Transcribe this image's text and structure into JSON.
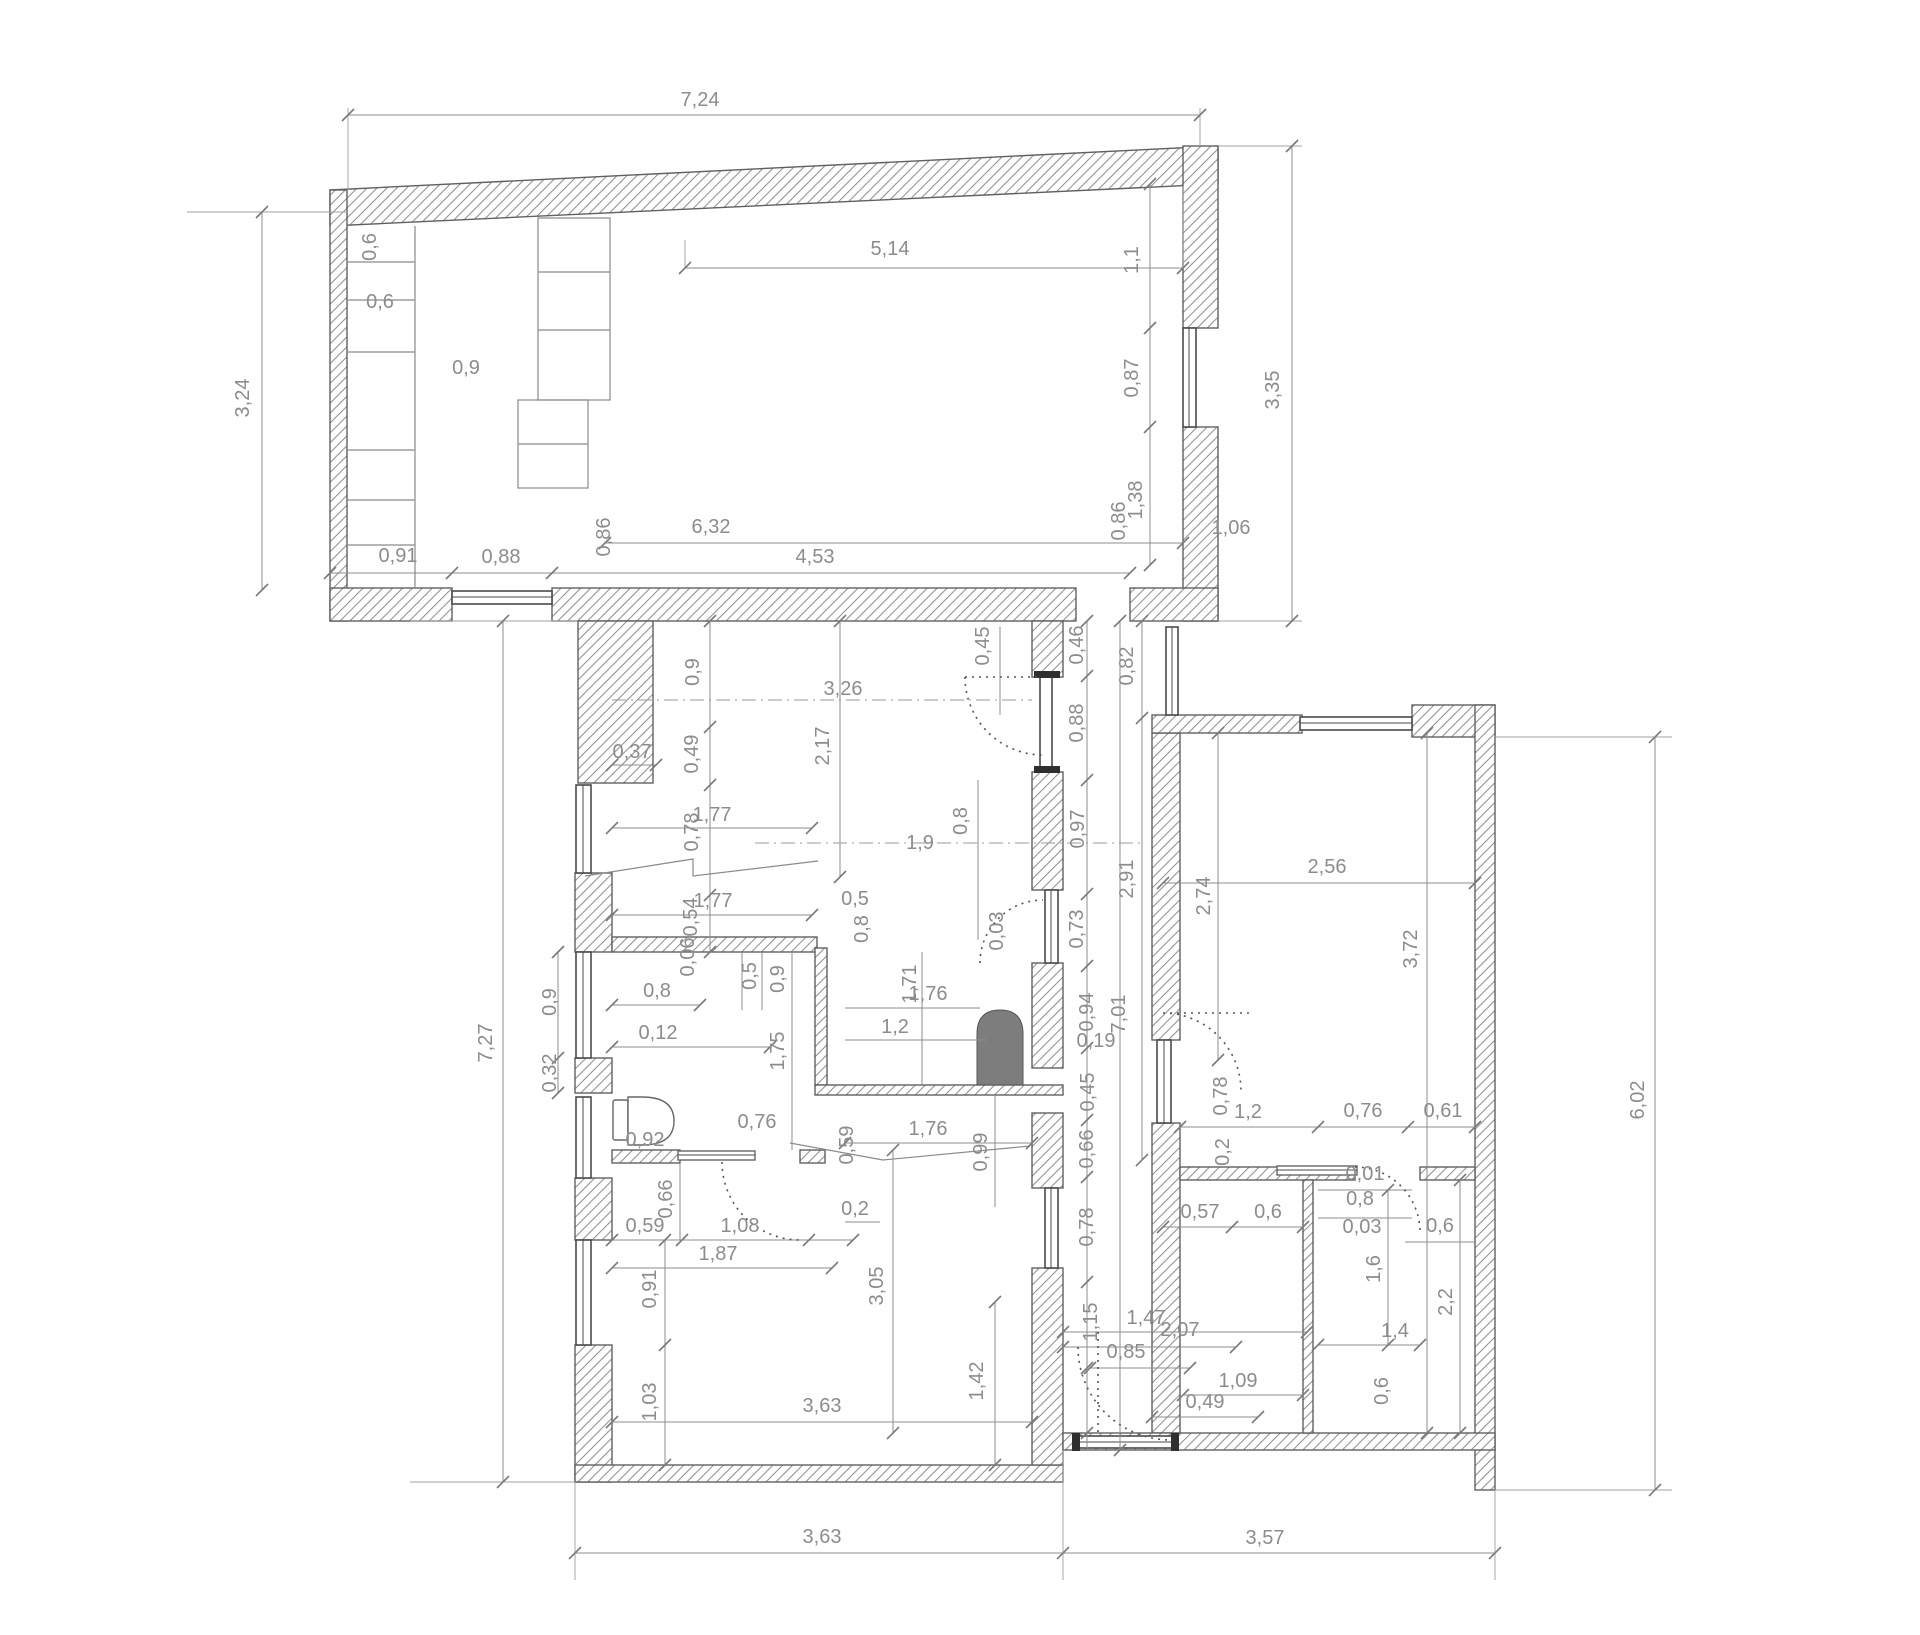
{
  "drawing": {
    "type_label": "floor-plan",
    "colors": {
      "background": "#ffffff",
      "dimension_text": "#8c8c8c",
      "wall_outline": "#606060",
      "hatch": "#909090",
      "stove_fill": "#7d7d7d",
      "door_cap": "#2f2f2f"
    },
    "labels": [
      {
        "t": "7,24",
        "x": 700,
        "y": 100,
        "r": 0
      },
      {
        "t": "3,24",
        "x": 243,
        "y": 398,
        "r": 1
      },
      {
        "t": "0,6",
        "x": 370,
        "y": 247,
        "r": 1
      },
      {
        "t": "0,6",
        "x": 380,
        "y": 302,
        "r": 0
      },
      {
        "t": "0,9",
        "x": 466,
        "y": 368,
        "r": 0
      },
      {
        "t": "5,14",
        "x": 890,
        "y": 249,
        "r": 0
      },
      {
        "t": "1,1",
        "x": 1132,
        "y": 260,
        "r": 1
      },
      {
        "t": "0,87",
        "x": 1132,
        "y": 378,
        "r": 1
      },
      {
        "t": "1,38",
        "x": 1136,
        "y": 500,
        "r": 1
      },
      {
        "t": "0,86",
        "x": 1119,
        "y": 521,
        "r": 1
      },
      {
        "t": "1,06",
        "x": 1231,
        "y": 528,
        "r": 0
      },
      {
        "t": "3,35",
        "x": 1273,
        "y": 390,
        "r": 1
      },
      {
        "t": "0,91",
        "x": 398,
        "y": 556,
        "r": 0
      },
      {
        "t": "0,88",
        "x": 501,
        "y": 557,
        "r": 0
      },
      {
        "t": "0,86",
        "x": 604,
        "y": 537,
        "r": 1
      },
      {
        "t": "6,32",
        "x": 711,
        "y": 527,
        "r": 0
      },
      {
        "t": "4,53",
        "x": 815,
        "y": 557,
        "r": 0
      },
      {
        "t": "0,9",
        "x": 693,
        "y": 672,
        "r": 1
      },
      {
        "t": "3,26",
        "x": 843,
        "y": 689,
        "r": 0
      },
      {
        "t": "0,37",
        "x": 632,
        "y": 752,
        "r": 0
      },
      {
        "t": "0,49",
        "x": 692,
        "y": 754,
        "r": 1
      },
      {
        "t": "2,17",
        "x": 823,
        "y": 746,
        "r": 1
      },
      {
        "t": "1,77",
        "x": 712,
        "y": 815,
        "r": 0
      },
      {
        "t": "0,78",
        "x": 692,
        "y": 832,
        "r": 1
      },
      {
        "t": "1,9",
        "x": 920,
        "y": 843,
        "r": 0
      },
      {
        "t": "1,77",
        "x": 713,
        "y": 901,
        "r": 0
      },
      {
        "t": "0,54",
        "x": 691,
        "y": 917,
        "r": 1
      },
      {
        "t": "0,45",
        "x": 983,
        "y": 646,
        "r": 1
      },
      {
        "t": "0,46",
        "x": 1077,
        "y": 645,
        "r": 1
      },
      {
        "t": "0,82",
        "x": 1127,
        "y": 666,
        "r": 1
      },
      {
        "t": "0,88",
        "x": 1077,
        "y": 723,
        "r": 1
      },
      {
        "t": "0,97",
        "x": 1078,
        "y": 829,
        "r": 1
      },
      {
        "t": "2,91",
        "x": 1127,
        "y": 879,
        "r": 1
      },
      {
        "t": "0,8",
        "x": 961,
        "y": 821,
        "r": 1
      },
      {
        "t": "0,73",
        "x": 1077,
        "y": 929,
        "r": 1
      },
      {
        "t": "0,03",
        "x": 997,
        "y": 931,
        "r": 1
      },
      {
        "t": "0,94",
        "x": 1087,
        "y": 1012,
        "r": 1
      },
      {
        "t": "0,19",
        "x": 1096,
        "y": 1041,
        "r": 0
      },
      {
        "t": "7,01",
        "x": 1119,
        "y": 1014,
        "r": 1
      },
      {
        "t": "0,45",
        "x": 1088,
        "y": 1092,
        "r": 1
      },
      {
        "t": "0,66",
        "x": 1087,
        "y": 1149,
        "r": 1
      },
      {
        "t": "0,78",
        "x": 1087,
        "y": 1227,
        "r": 1
      },
      {
        "t": "1,15",
        "x": 1091,
        "y": 1322,
        "r": 1
      },
      {
        "t": "1,47",
        "x": 1146,
        "y": 1318,
        "r": 0
      },
      {
        "t": "0,85",
        "x": 1126,
        "y": 1352,
        "r": 0
      },
      {
        "t": "2,07",
        "x": 1180,
        "y": 1330,
        "r": 0
      },
      {
        "t": "0,5",
        "x": 750,
        "y": 976,
        "r": 1
      },
      {
        "t": "0,9",
        "x": 778,
        "y": 979,
        "r": 1
      },
      {
        "t": "0,8",
        "x": 657,
        "y": 991,
        "r": 0
      },
      {
        "t": "0,12",
        "x": 658,
        "y": 1033,
        "r": 0
      },
      {
        "t": "1,75",
        "x": 778,
        "y": 1051,
        "r": 1
      },
      {
        "t": "0,06",
        "x": 688,
        "y": 957,
        "r": 1
      },
      {
        "t": "0,8",
        "x": 862,
        "y": 929,
        "r": 1
      },
      {
        "t": "0,5",
        "x": 855,
        "y": 899,
        "r": 0
      },
      {
        "t": "1,71",
        "x": 910,
        "y": 984,
        "r": 1
      },
      {
        "t": "1,76",
        "x": 928,
        "y": 994,
        "r": 0
      },
      {
        "t": "1,2",
        "x": 895,
        "y": 1027,
        "r": 0
      },
      {
        "t": "1,76",
        "x": 928,
        "y": 1129,
        "r": 0
      },
      {
        "t": "0,59",
        "x": 847,
        "y": 1145,
        "r": 1
      },
      {
        "t": "0,99",
        "x": 981,
        "y": 1152,
        "r": 1
      },
      {
        "t": "0,2",
        "x": 855,
        "y": 1209,
        "r": 0
      },
      {
        "t": "0,76",
        "x": 757,
        "y": 1122,
        "r": 0
      },
      {
        "t": "0,92",
        "x": 645,
        "y": 1140,
        "r": 0
      },
      {
        "t": "7,27",
        "x": 486,
        "y": 1043,
        "r": 1
      },
      {
        "t": "0,9",
        "x": 550,
        "y": 1002,
        "r": 1
      },
      {
        "t": "0,32",
        "x": 550,
        "y": 1073,
        "r": 1
      },
      {
        "t": "0,66",
        "x": 666,
        "y": 1199,
        "r": 1
      },
      {
        "t": "0,59",
        "x": 645,
        "y": 1226,
        "r": 0
      },
      {
        "t": "1,08",
        "x": 740,
        "y": 1226,
        "r": 0
      },
      {
        "t": "1,87",
        "x": 718,
        "y": 1254,
        "r": 0
      },
      {
        "t": "0,91",
        "x": 650,
        "y": 1289,
        "r": 1
      },
      {
        "t": "3,05",
        "x": 877,
        "y": 1286,
        "r": 1
      },
      {
        "t": "1,03",
        "x": 650,
        "y": 1402,
        "r": 1
      },
      {
        "t": "3,63",
        "x": 822,
        "y": 1406,
        "r": 0
      },
      {
        "t": "1,42",
        "x": 977,
        "y": 1381,
        "r": 1
      },
      {
        "t": "3,63",
        "x": 822,
        "y": 1537,
        "r": 0
      },
      {
        "t": "3,57",
        "x": 1265,
        "y": 1538,
        "r": 0
      },
      {
        "t": "2,56",
        "x": 1327,
        "y": 867,
        "r": 0
      },
      {
        "t": "2,74",
        "x": 1204,
        "y": 896,
        "r": 1
      },
      {
        "t": "3,72",
        "x": 1411,
        "y": 949,
        "r": 1
      },
      {
        "t": "6,02",
        "x": 1638,
        "y": 1100,
        "r": 1
      },
      {
        "t": "0,78",
        "x": 1221,
        "y": 1096,
        "r": 1
      },
      {
        "t": "1,2",
        "x": 1248,
        "y": 1112,
        "r": 0
      },
      {
        "t": "0,76",
        "x": 1363,
        "y": 1111,
        "r": 0
      },
      {
        "t": "0,61",
        "x": 1443,
        "y": 1111,
        "r": 0
      },
      {
        "t": "0,2",
        "x": 1223,
        "y": 1152,
        "r": 1
      },
      {
        "t": "0,01",
        "x": 1365,
        "y": 1174,
        "r": 0
      },
      {
        "t": "0,8",
        "x": 1360,
        "y": 1199,
        "r": 0
      },
      {
        "t": "0,03",
        "x": 1362,
        "y": 1227,
        "r": 0
      },
      {
        "t": "0,6",
        "x": 1440,
        "y": 1226,
        "r": 0
      },
      {
        "t": "0,57",
        "x": 1200,
        "y": 1212,
        "r": 0
      },
      {
        "t": "0,6",
        "x": 1268,
        "y": 1212,
        "r": 0
      },
      {
        "t": "1,6",
        "x": 1374,
        "y": 1269,
        "r": 1
      },
      {
        "t": "2,2",
        "x": 1446,
        "y": 1302,
        "r": 1
      },
      {
        "t": "1,4",
        "x": 1395,
        "y": 1331,
        "r": 0
      },
      {
        "t": "1,09",
        "x": 1238,
        "y": 1381,
        "r": 0
      },
      {
        "t": "0,49",
        "x": 1205,
        "y": 1402,
        "r": 0
      },
      {
        "t": "0,6",
        "x": 1382,
        "y": 1391,
        "r": 1
      }
    ]
  }
}
